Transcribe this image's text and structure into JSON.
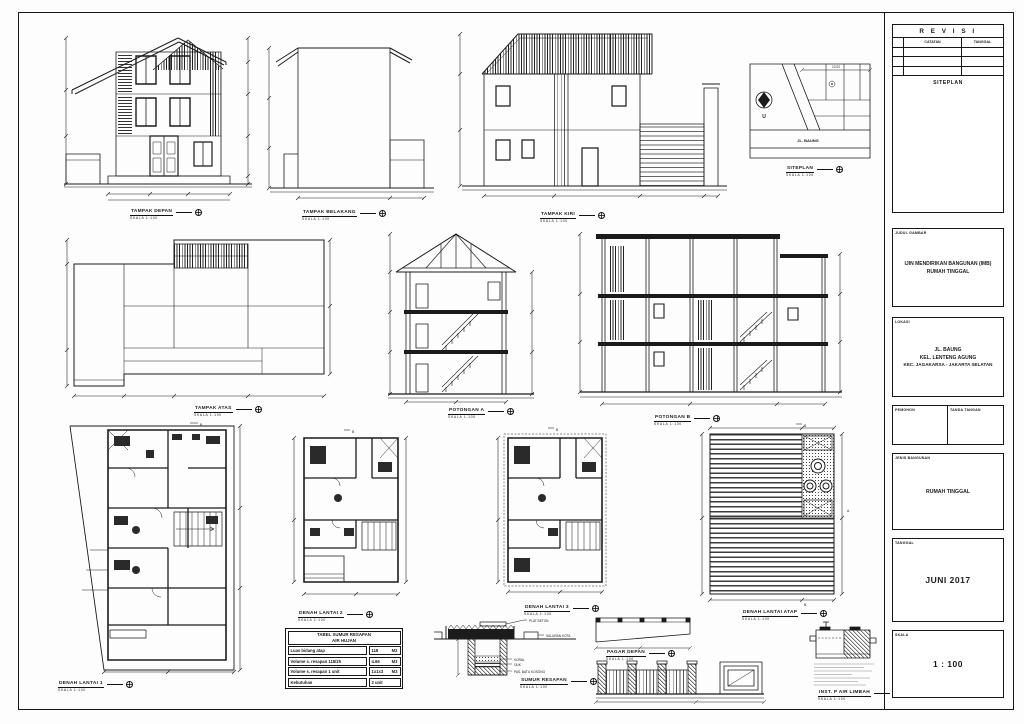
{
  "common": {
    "scale_note": "SKALA 1:100"
  },
  "views": {
    "tampak_depan": {
      "title": "TAMPAK DEPAN"
    },
    "tampak_belakang": {
      "title": "TAMPAK BELAKANG"
    },
    "tampak_kiri": {
      "title": "TAMPAK KIRI"
    },
    "siteplan": {
      "title": "SITEPLAN"
    },
    "tampak_atas": {
      "title": "TAMPAK ATAS"
    },
    "potongan_a": {
      "title": "POTONGAN A"
    },
    "potongan_b": {
      "title": "POTONGAN B"
    },
    "denah_lantai_1": {
      "title": "DENAH LANTAI 1"
    },
    "denah_lantai_2": {
      "title": "DENAH LANTAI 2"
    },
    "denah_lantai_3": {
      "title": "DENAH LANTAI 3"
    },
    "denah_lantai_atap": {
      "title": "DENAH LANTAI ATAP"
    },
    "sumur_resapan": {
      "title": "SUMUR RESAPAN"
    },
    "pagar_depan": {
      "title": "PAGAR DEPAN"
    },
    "inst_air_limbah": {
      "title": "INST. P AIR LIMBAH"
    }
  },
  "siteplan_detail": {
    "street": "JL. BAUNG",
    "north_label": "U",
    "dim_top": "12.00"
  },
  "markers": {
    "a": "A",
    "b": "B"
  },
  "resapan_table": {
    "title_line1": "TABEL SUMUR RESAPAN",
    "title_line2": "AIR HUJAN",
    "rows": [
      {
        "label": "Luas bidang atap",
        "value": "118",
        "unit": "M2"
      },
      {
        "label": "Volume s. resapan  118/25",
        "value": "4.66",
        "unit": "M3"
      },
      {
        "label": "Volume s. resapan 1 unit",
        "value": "1x1x3",
        "unit": "M3"
      },
      {
        "label": "Kebutuhan",
        "value": "2 unit",
        "unit": ""
      }
    ]
  },
  "sumur_annotations": {
    "plat_beton": "PLAT BETON",
    "saluran": "SALURAN KOTA",
    "koral": "KORAL",
    "ijuk": "IJUK",
    "pas_batu": "PAS. BATU KOSONG"
  },
  "titleblock": {
    "revisi_title": "R E V I S I",
    "col_catatan": "CATATAN",
    "col_tanggal": "TANGGAL",
    "siteplan_label": "SITEPLAN",
    "judul_label": "JUDUL GAMBAR",
    "judul_line1": "IJIN MENDIRIKAN BANGUNAN (IMB)",
    "judul_line2": "RUMAH TINGGAL",
    "lokasi_label": "LOKASI",
    "lokasi_line1": "JL. BAUNG",
    "lokasi_line2": "KEL. LENTENG AGUNG",
    "lokasi_line3": "KEC. JAGAKARSA - JAKARTA SELATAN",
    "pemohon_label": "PEMOHON",
    "tandatangan_label": "TANDA TANGAN",
    "jenis_label": "JENIS BANGUNAN",
    "jenis_value": "RUMAH TINGGAL",
    "tanggal_label": "TANGGAL",
    "tanggal_value": "JUNI 2017",
    "skala_label": "SKALA",
    "skala_value": "1 : 100"
  }
}
